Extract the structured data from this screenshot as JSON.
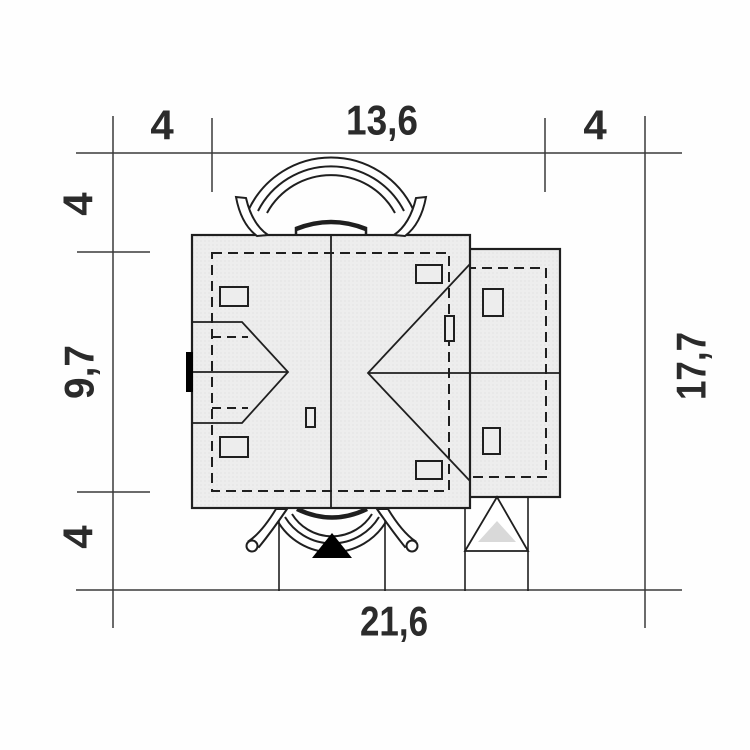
{
  "drawing": {
    "type": "house-roof-site-plan",
    "colors": {
      "line": "#1f1f1f",
      "dimension_line": "#3a3a3a",
      "roof_fill": "#ededed",
      "roof_dot": "#d9d9d9",
      "entry_marker_fill": "#000000",
      "garage_marker_fill": "#d9d9d9",
      "text": "#2b2b2b",
      "background": "#fefefe"
    },
    "dimensions": {
      "top": {
        "left_margin": "4",
        "building_width": "13,6",
        "right_margin": "4"
      },
      "left": {
        "top_margin": "4",
        "building_depth": "9,7",
        "bottom_margin": "4"
      },
      "right": {
        "total_depth": "17,7"
      },
      "bottom": {
        "total_width": "21,6"
      }
    }
  }
}
